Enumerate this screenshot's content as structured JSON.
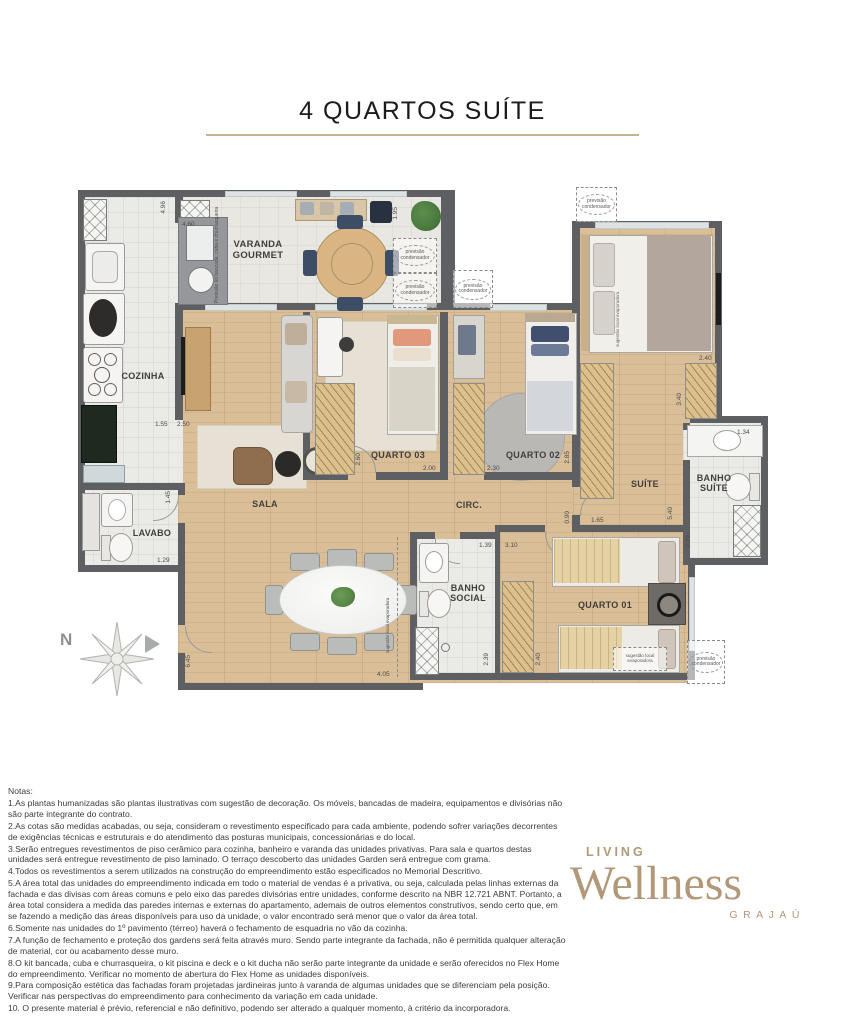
{
  "title": "4 QUARTOS SUÍTE",
  "plan": {
    "rooms": {
      "cozinha": "COZINHA",
      "varanda": "VARANDA GOURMET",
      "sala": "SALA",
      "lavabo": "LAVABO",
      "quarto03": "QUARTO 03",
      "quarto02": "QUARTO 02",
      "circ": "CIRC.",
      "suite": "SUÍTE",
      "banho_suite": "BANHO SUÍTE",
      "banho_social": "BANHO SOCIAL",
      "quarto01": "QUARTO 01"
    },
    "annotations": {
      "previsao_kit": "Previsão kit bancada, cuba e churrasqueira",
      "previsao_condensador": "previsão condensador",
      "sugestao_evaporadora": "sugestão local evaporadora",
      "north": "N"
    },
    "dims": {
      "cozinha_h": "4.96",
      "kit": "4.60",
      "passagem_a": "1.55",
      "passagem_b": "2.50",
      "varanda": "1.95",
      "q03_l": "2.60",
      "q03_w": "2.00",
      "q02_w": "2.30",
      "q02_h": "2.85",
      "suite_closet_w": "2.40",
      "suite_closet_h": "3.40",
      "bsuite_w": "1.34",
      "bsuite_h": "2.29",
      "circ_w": "0.90",
      "suite_porta": "1.65",
      "suite_h": "5.40",
      "lavabo_h": "1.45",
      "lavabo_w": "1.29",
      "bsocial_w": "1.39",
      "hall_w": "3.10",
      "bsocial_h": "2.39",
      "closet_h": "2.40",
      "sala_h": "6.45",
      "sala_w": "4.05"
    }
  },
  "notes": {
    "heading": "Notas:",
    "items": [
      "1.As plantas humanizadas são plantas ilustrativas com sugestão de decoração. Os móveis, bancadas de madeira, equipamentos e divisórias não são parte integrante do contrato.",
      "2.As cotas são medidas acabadas, ou seja, consideram o revestimento especificado para cada ambiente, podendo sofrer variações decorrentes de exigências técnicas e estruturais e do atendimento das posturas municipais, concessionárias e do local.",
      "3.Serão entregues revestimentos de piso cerâmico para cozinha, banheiro e varanda das unidades privativas. Para sala e quartos destas unidades será entregue revestimento de piso laminado. O terraço descoberto das unidades Garden será entregue com grama.",
      "4.Todos os revestimentos a serem utilizados na construção do empreendimento estão especificados no Memorial Descritivo.",
      "5.A área total das unidades do empreendimento indicada em todo o material de vendas é a privativa, ou seja, calculada pelas linhas externas da fachada e das divisas com áreas comuns e pelo eixo das paredes divisórias entre unidades, conforme descrito na NBR 12.721 ABNT. Portanto, a área total considera a medida das paredes internas e externas do apartamento, ademais de outros elementos construtivos, sendo certo que, em se fazendo a medição das áreas disponíveis para uso da unidade, o valor encontrado será menor que o valor da área total.",
      "6.Somente nas unidades do 1º pavimento (térreo) haverá o fechamento de esquadria no vão da cozinha.",
      "7.A função de fechamento e proteção dos gardens será feita através muro. Sendo parte integrante da fachada, não é permitida qualquer alteração de material, cor ou acabamento desse muro.",
      "8.O kit bancada, cuba e churrasqueira, o kit piscina e deck e o kit ducha não serão parte integrante da unidade e serão oferecidos no Flex Home do empreendimento. Verificar no momento de abertura do Flex Home as unidades disponíveis.",
      "9.Para composição estética das fachadas foram projetadas jardineiras junto à varanda de algumas unidades que se diferenciam pela posição. Verificar nas perspectivas do empreendimento para conhecimento da variação em cada unidade.",
      "10. O presente material é prévio, referencial e não definitivo, podendo ser alterado a qualquer momento, à critério da incorporadora."
    ]
  },
  "logo": {
    "living": "LIVING",
    "wellness": "Wellness",
    "grajau": "GRAJAÚ"
  }
}
